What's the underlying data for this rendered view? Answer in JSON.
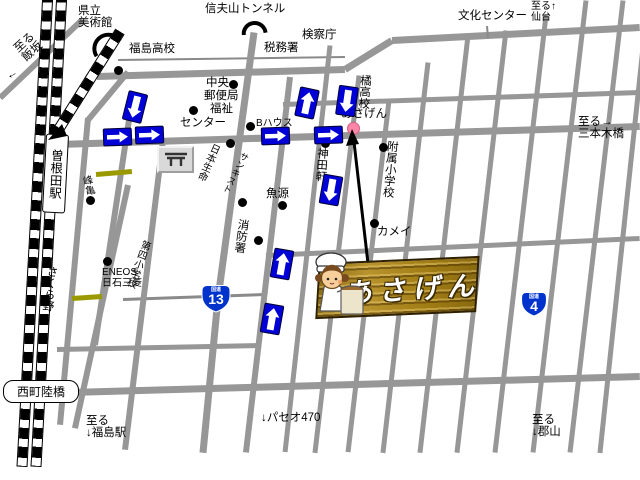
{
  "map": {
    "colors": {
      "road": "#979797",
      "thin_road": "#8a8a8a",
      "railway": "#000000",
      "arrow_blue": "#0000d6",
      "badge_blue": "#0033cc",
      "olive": "#9a9a00",
      "pink": "#ff85a8",
      "banner_gold": "#a8861f"
    },
    "labels": [
      {
        "id": "pref-art-museum",
        "text": "県立\n美術館",
        "x": 78,
        "y": 5
      },
      {
        "id": "shinobuyama-tunnel",
        "text": "信夫山トンネル",
        "x": 205,
        "y": 3
      },
      {
        "id": "prosecutors-office",
        "text": "検察庁",
        "x": 302,
        "y": 29
      },
      {
        "id": "tax-office",
        "text": "税務署",
        "x": 264,
        "y": 42
      },
      {
        "id": "culture-center",
        "text": "文化センター",
        "x": 458,
        "y": 10
      },
      {
        "id": "to-sendai",
        "text": "至る↑\n仙台",
        "x": 531,
        "y": 2,
        "fs": 10
      },
      {
        "id": "fukushima-highschool",
        "text": "福島高校",
        "x": 129,
        "y": 43
      },
      {
        "id": "chuo",
        "text": "中央",
        "x": 206,
        "y": 77
      },
      {
        "id": "post-office",
        "text": "郵便局",
        "x": 204,
        "y": 90
      },
      {
        "id": "fukushi",
        "text": "福祉",
        "x": 210,
        "y": 103
      },
      {
        "id": "center",
        "text": "センター",
        "x": 180,
        "y": 117
      },
      {
        "id": "b-house",
        "text": "Bハウス",
        "x": 256,
        "y": 119,
        "fs": 10
      },
      {
        "id": "uogen",
        "text": "魚源",
        "x": 266,
        "y": 188
      },
      {
        "id": "kandaken",
        "text": "神田軒",
        "x": 316,
        "y": 147,
        "vert": true,
        "rot": 4
      },
      {
        "id": "tachibana-highschool",
        "text": "橘高校",
        "x": 359,
        "y": 74,
        "vert": true,
        "rot": 4
      },
      {
        "id": "asagen-small",
        "text": "あさげん",
        "x": 341,
        "y": 108
      },
      {
        "id": "fuzoku-elementary",
        "text": "附属小学校",
        "x": 386,
        "y": 140,
        "vert": true,
        "rot": 5
      },
      {
        "id": "to-sanbongi-bridge",
        "text": "至る→\n三本木橋",
        "x": 578,
        "y": 116
      },
      {
        "id": "kamei",
        "text": "カメイ",
        "x": 377,
        "y": 226
      },
      {
        "id": "eneos",
        "text": "ENEOS\n日石三菱",
        "x": 102,
        "y": 268,
        "fs": 10
      },
      {
        "id": "fire-station",
        "text": "消防署",
        "x": 237,
        "y": 218,
        "vert": true,
        "rot": 8
      },
      {
        "id": "paseo470",
        "text": "↓パセオ470",
        "x": 261,
        "y": 412
      },
      {
        "id": "to-fukushima-station",
        "text": "至る\n↓福島駅",
        "x": 86,
        "y": 415
      },
      {
        "id": "to-koriyama",
        "text": "至る\n↓郡山",
        "x": 532,
        "y": 414
      },
      {
        "id": "to-iizaka",
        "text": "至る\n飯坂",
        "x": 12,
        "y": 46,
        "rot": -42
      },
      {
        "id": "iizaka-arrow",
        "text": "←",
        "x": 4,
        "y": 72,
        "rot": -30
      },
      {
        "id": "sakurano",
        "text": "さくら野",
        "x": 46,
        "y": 265,
        "vert": true,
        "rot": 7
      },
      {
        "id": "minekame",
        "text": "峰亀",
        "x": 79,
        "y": 177,
        "vert": true,
        "rot": -12,
        "fs": 10
      },
      {
        "id": "nihon-seimei",
        "text": "日本生命",
        "x": 210,
        "y": 141,
        "vert": true,
        "rot": 24,
        "fs": 10
      },
      {
        "id": "sunkist",
        "text": "サンキスト",
        "x": 241,
        "y": 150,
        "vert": true,
        "rot": 28,
        "fs": 9
      },
      {
        "id": "daiyon-elementary",
        "text": "第四小学校",
        "x": 140,
        "y": 238,
        "vert": true,
        "rot": 20,
        "fs": 10
      }
    ],
    "boxed_labels": [
      {
        "id": "soneda-station",
        "text": "曽根田駅",
        "x": 44,
        "y": 134,
        "w": 21,
        "h": 77,
        "vert": true,
        "rot": 3,
        "fs": 12.5,
        "r": 3
      },
      {
        "id": "nishimachi-overpass",
        "text": "西町陸橋",
        "x": 3,
        "y": 380,
        "w": 74,
        "h": 21,
        "fs": 12,
        "r": 10
      }
    ],
    "roads": [
      {
        "x1": 82,
        "y1": 20,
        "x2": 0,
        "y2": 98,
        "w": 6
      },
      {
        "x1": 118,
        "y1": 60,
        "x2": 345,
        "y2": 57,
        "w": 2,
        "thin": true
      },
      {
        "x1": 97,
        "y1": 76,
        "x2": 345,
        "y2": 69,
        "w": 7
      },
      {
        "x1": 345,
        "y1": 69,
        "x2": 392,
        "y2": 40,
        "w": 7
      },
      {
        "x1": 392,
        "y1": 40,
        "x2": 640,
        "y2": 27,
        "w": 7
      },
      {
        "x1": 283,
        "y1": 104,
        "x2": 640,
        "y2": 92,
        "w": 5
      },
      {
        "x1": 58,
        "y1": 144,
        "x2": 640,
        "y2": 126,
        "w": 7
      },
      {
        "x1": 266,
        "y1": 255,
        "x2": 640,
        "y2": 238,
        "w": 5
      },
      {
        "x1": 123,
        "y1": 299,
        "x2": 266,
        "y2": 294,
        "w": 3,
        "thin": true
      },
      {
        "x1": 57,
        "y1": 349,
        "x2": 260,
        "y2": 345,
        "w": 5
      },
      {
        "x1": 70,
        "y1": 392,
        "x2": 640,
        "y2": 376,
        "w": 7
      },
      {
        "x1": 487,
        "y1": 26,
        "x2": 488,
        "y2": 38,
        "w": 2,
        "thin": true
      },
      {
        "x1": 88,
        "y1": 118,
        "x2": 60,
        "y2": 425,
        "w": 6
      },
      {
        "x1": 128,
        "y1": 185,
        "x2": 75,
        "y2": 428,
        "w": 6
      },
      {
        "x1": 132,
        "y1": 100,
        "x2": 95,
        "y2": 345,
        "w": 6
      },
      {
        "x1": 128,
        "y1": 72,
        "x2": 88,
        "y2": 120,
        "w": 6
      },
      {
        "x1": 163,
        "y1": 140,
        "x2": 125,
        "y2": 450,
        "w": 6
      },
      {
        "x1": 290,
        "y1": 77,
        "x2": 246,
        "y2": 452,
        "w": 6
      },
      {
        "x1": 330,
        "y1": 45,
        "x2": 285,
        "y2": 452,
        "w": 5
      },
      {
        "x1": 359,
        "y1": 75,
        "x2": 315,
        "y2": 452,
        "w": 5
      },
      {
        "x1": 389,
        "y1": 100,
        "x2": 348,
        "y2": 452,
        "w": 5
      },
      {
        "x1": 428,
        "y1": 62,
        "x2": 383,
        "y2": 452,
        "w": 5
      },
      {
        "x1": 468,
        "y1": 35,
        "x2": 420,
        "y2": 452,
        "w": 5
      },
      {
        "x1": 506,
        "y1": 30,
        "x2": 457,
        "y2": 452,
        "w": 5
      },
      {
        "x1": 546,
        "y1": 15,
        "x2": 495,
        "y2": 452,
        "w": 5
      },
      {
        "x1": 586,
        "y1": 0,
        "x2": 533,
        "y2": 452,
        "w": 5
      },
      {
        "x1": 623,
        "y1": 0,
        "x2": 570,
        "y2": 452,
        "w": 5
      },
      {
        "x1": 648,
        "y1": 0,
        "x2": 600,
        "y2": 452,
        "w": 5
      },
      {
        "x1": 254,
        "y1": 32,
        "x2": 240,
        "y2": 135,
        "w": 7
      },
      {
        "x1": 240,
        "y1": 135,
        "x2": 218,
        "y2": 298,
        "w": 7
      },
      {
        "x1": 218,
        "y1": 298,
        "x2": 203,
        "y2": 452,
        "w": 7
      }
    ],
    "railways": [
      {
        "x1": 48,
        "y1": -10,
        "x2": 22,
        "y2": 465
      },
      {
        "x1": 62,
        "y1": -10,
        "x2": 36,
        "y2": 465
      },
      {
        "x1": 120,
        "y1": 30,
        "x2": 56,
        "y2": 132
      }
    ],
    "olive_bars": [
      {
        "x1": 96,
        "y1": 174,
        "x2": 132,
        "y2": 171,
        "w": 5
      },
      {
        "x1": 72,
        "y1": 298,
        "x2": 102,
        "y2": 296,
        "w": 5
      }
    ],
    "tunnels": [
      {
        "cx": 104,
        "cy": 50,
        "r": 16,
        "rot": -33
      },
      {
        "cx": 254,
        "cy": 34,
        "r": 13,
        "rot": -6
      }
    ],
    "dots": [
      {
        "x": 118,
        "y": 70
      },
      {
        "x": 233,
        "y": 84
      },
      {
        "x": 193,
        "y": 110
      },
      {
        "x": 250,
        "y": 126
      },
      {
        "x": 230,
        "y": 143
      },
      {
        "x": 90,
        "y": 200
      },
      {
        "x": 242,
        "y": 202
      },
      {
        "x": 282,
        "y": 205
      },
      {
        "x": 325,
        "y": 143
      },
      {
        "x": 383,
        "y": 147
      },
      {
        "x": 374,
        "y": 223
      },
      {
        "x": 258,
        "y": 240
      },
      {
        "x": 107,
        "y": 261
      }
    ],
    "shop_dot": {
      "x": 352,
      "y": 127
    },
    "arrows": [
      {
        "dir": "down",
        "x": 125,
        "y": 92,
        "rot": 14
      },
      {
        "dir": "right",
        "x": 103,
        "y": 128,
        "rot": -2
      },
      {
        "dir": "right",
        "x": 135,
        "y": 126,
        "rot": -2
      },
      {
        "dir": "up",
        "x": 297,
        "y": 88,
        "rot": 12
      },
      {
        "dir": "down",
        "x": 337,
        "y": 86,
        "rot": 8
      },
      {
        "dir": "right",
        "x": 261,
        "y": 127,
        "rot": -2
      },
      {
        "dir": "right",
        "x": 314,
        "y": 126,
        "rot": -2
      },
      {
        "dir": "down",
        "x": 321,
        "y": 175,
        "rot": 10
      },
      {
        "dir": "up",
        "x": 272,
        "y": 249,
        "rot": 10
      },
      {
        "dir": "up",
        "x": 262,
        "y": 304,
        "rot": 10
      }
    ],
    "route_badges": [
      {
        "id": "route-13",
        "kokudo": "国道",
        "num": "13",
        "x": 199,
        "y": 283,
        "w": 34,
        "h": 31
      },
      {
        "id": "route-4",
        "kokudo": "国道",
        "num": "4",
        "x": 519,
        "y": 290,
        "w": 30,
        "h": 28
      }
    ],
    "pointer": {
      "x1": 369,
      "y1": 272,
      "x2": 354,
      "y2": 142,
      "head": "352,129 346,146 359,144"
    },
    "branch_tip": "48,140 62,124 67,136",
    "logo": {
      "text": "あさげん",
      "x": 317,
      "y": 263,
      "w": 157,
      "h": 52,
      "rot": -2.5
    },
    "cook": {
      "x": 304,
      "y": 250
    },
    "gate_icon": {
      "x": 157,
      "y": 146,
      "w": 33,
      "h": 23
    }
  }
}
